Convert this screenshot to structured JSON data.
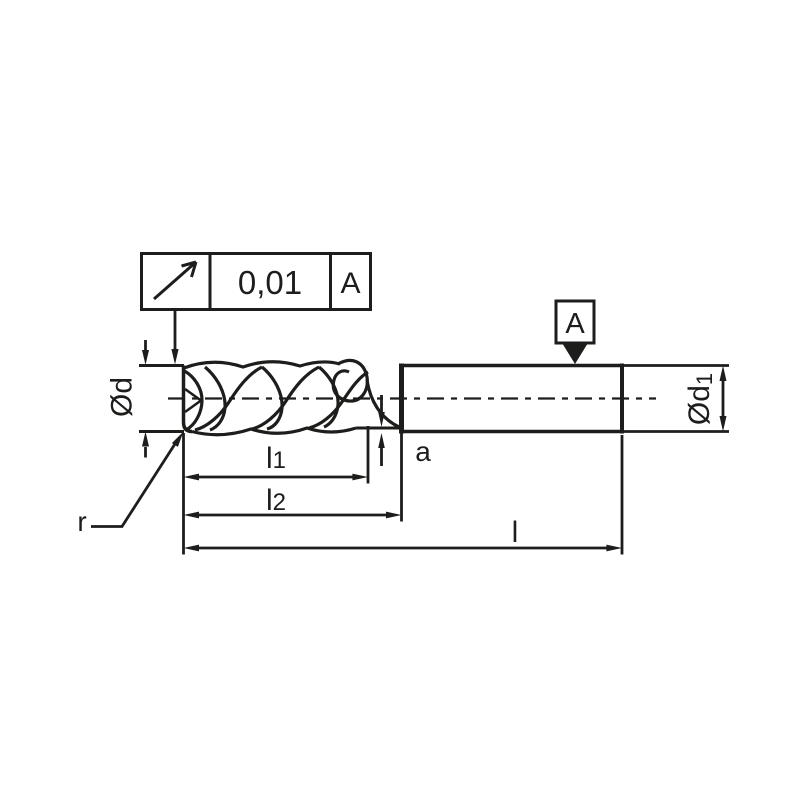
{
  "colors": {
    "ink": "#1d1d1b",
    "background": "#ffffff"
  },
  "tolerance_frame": {
    "symbol_icon": "circular-runout-arrow",
    "value": "0,01",
    "datum_ref": "A"
  },
  "datum_flag": {
    "label": "A"
  },
  "labels": {
    "diameter_d": {
      "main": "Ød",
      "sub": ""
    },
    "diameter_d1": {
      "main": "Ød",
      "sub": "1"
    },
    "length_l1": {
      "main": "l",
      "sub": "1"
    },
    "length_l2": {
      "main": "l",
      "sub": "2"
    },
    "overall_length": {
      "main": "l",
      "sub": ""
    },
    "neck_gap": {
      "label": "a"
    },
    "corner_radius": {
      "label": "r"
    }
  }
}
